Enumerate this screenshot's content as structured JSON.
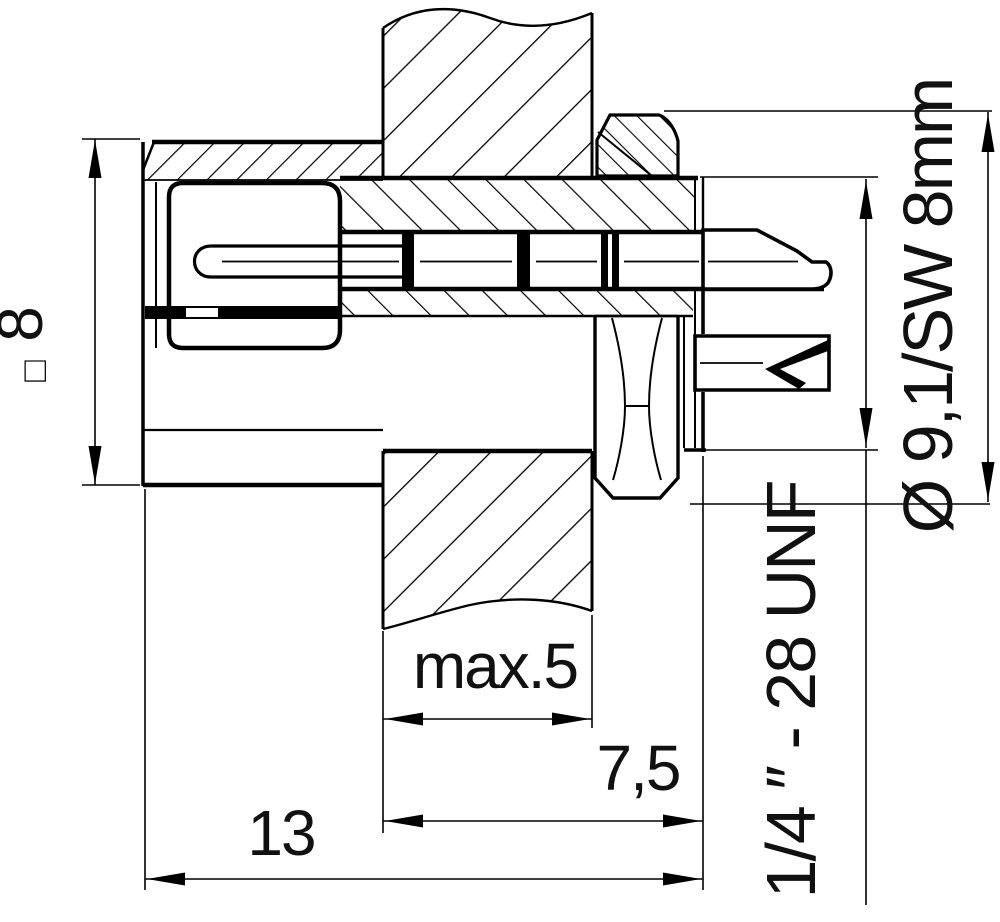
{
  "drawing": {
    "title": "panel-mount-connector-cross-section",
    "colors": {
      "line": "#000000",
      "background": "#ffffff"
    },
    "labels": {
      "body_size_symbol": "□",
      "body_size_value": "8",
      "diameter_note": "Ø 9,1/SW 8mm",
      "thread_note": "1/4 ″ - 28 UNF",
      "panel_thickness": "max.5",
      "flange_depth": "7,5",
      "total_length": "13"
    }
  }
}
